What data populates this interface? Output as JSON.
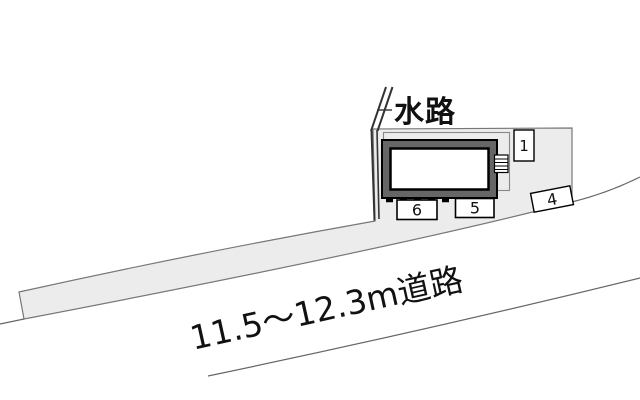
{
  "plan": {
    "waterway_label": "水路",
    "road_label": "11.5〜12.3m道路",
    "parking_spaces": [
      {
        "label": "1"
      },
      {
        "label": "6"
      },
      {
        "label": "5"
      },
      {
        "label": "4"
      }
    ],
    "colors": {
      "background": "#ffffff",
      "plot_fill": "#ececec",
      "boundary_line": "#666666",
      "building_frame": "#666666",
      "building_outline": "#000000",
      "building_inner": "#ffffff",
      "text": "#111111"
    }
  }
}
